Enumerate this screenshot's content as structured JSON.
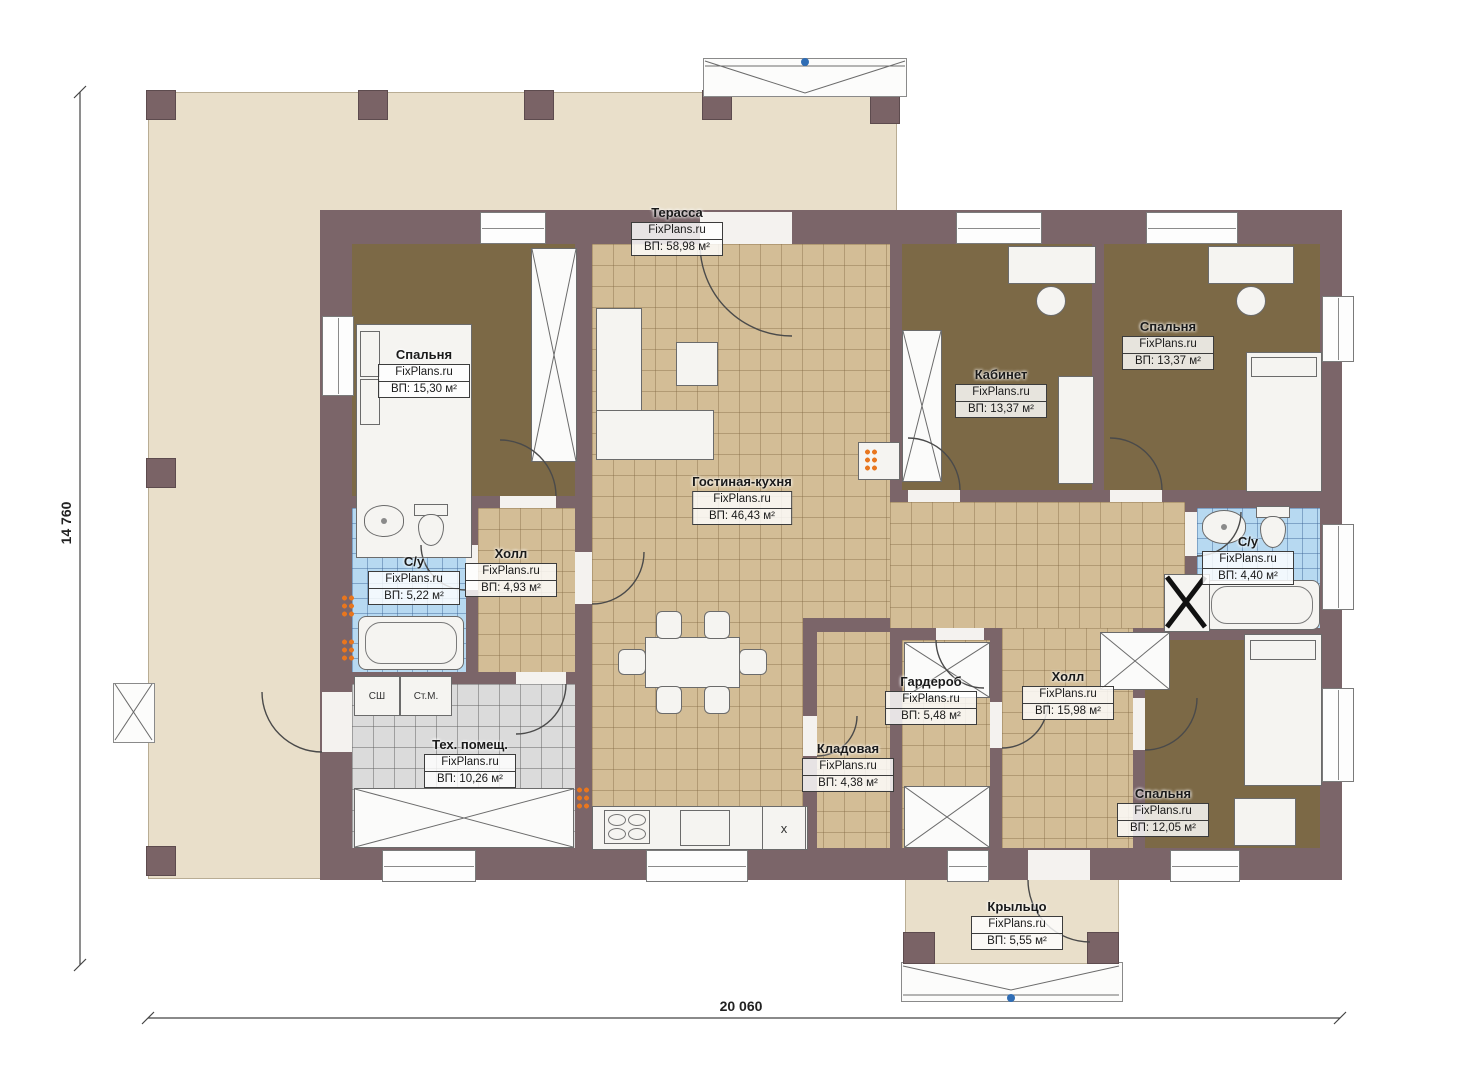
{
  "plan": {
    "type": "single-storey house floor plan",
    "brand_watermark": "FixPlans.ru"
  },
  "dimensions": {
    "overall_width": "20 060",
    "overall_height": "14 760"
  },
  "rooms": [
    {
      "id": "terrace",
      "name": "Терасса",
      "brand": "FixPlans.ru",
      "area": "ВП: 58,98 м²"
    },
    {
      "id": "bedroom-top-left",
      "name": "Спальня",
      "brand": "FixPlans.ru",
      "area": "ВП: 15,30 м²"
    },
    {
      "id": "bathroom-left",
      "name": "С/у",
      "brand": "FixPlans.ru",
      "area": "ВП: 5,22 м²"
    },
    {
      "id": "hall-left",
      "name": "Холл",
      "brand": "FixPlans.ru",
      "area": "ВП: 4,93 м²"
    },
    {
      "id": "living-kitchen",
      "name": "Гостиная-кухня",
      "brand": "FixPlans.ru",
      "area": "ВП: 46,43 м²"
    },
    {
      "id": "office",
      "name": "Кабинет",
      "brand": "FixPlans.ru",
      "area": "ВП: 13,37 м²"
    },
    {
      "id": "bedroom-top-right",
      "name": "Спальня",
      "brand": "FixPlans.ru",
      "area": "ВП: 13,37 м²"
    },
    {
      "id": "bathroom-right",
      "name": "С/у",
      "brand": "FixPlans.ru",
      "area": "ВП: 4,40 м²"
    },
    {
      "id": "wardrobe",
      "name": "Гардероб",
      "brand": "FixPlans.ru",
      "area": "ВП: 5,48 м²"
    },
    {
      "id": "hall-right",
      "name": "Холл",
      "brand": "FixPlans.ru",
      "area": "ВП: 15,98 м²"
    },
    {
      "id": "pantry",
      "name": "Кладовая",
      "brand": "FixPlans.ru",
      "area": "ВП: 4,38 м²"
    },
    {
      "id": "tech-room",
      "name": "Тех. помещ.",
      "brand": "FixPlans.ru",
      "area": "ВП: 10,26 м²"
    },
    {
      "id": "bedroom-bottom-right",
      "name": "Спальня",
      "brand": "FixPlans.ru",
      "area": "ВП: 12,05 м²"
    },
    {
      "id": "porch",
      "name": "Крыльцо",
      "brand": "FixPlans.ru",
      "area": "ВП: 5,55 м²"
    }
  ],
  "appliances": {
    "sh": "СШ",
    "stm": "Ст.М.",
    "kitchen_x": "x"
  },
  "colors": {
    "wall": "#7b6569",
    "terrace_floor": "#e9dfca",
    "tile_tan": "#d3bd96",
    "tile_blue": "#b7d9f1",
    "tile_gray": "#dbdbdb",
    "carpet_brown": "#7c6946",
    "accent_orange": "#e8761e",
    "stair_marker_blue": "#2f6db5"
  }
}
